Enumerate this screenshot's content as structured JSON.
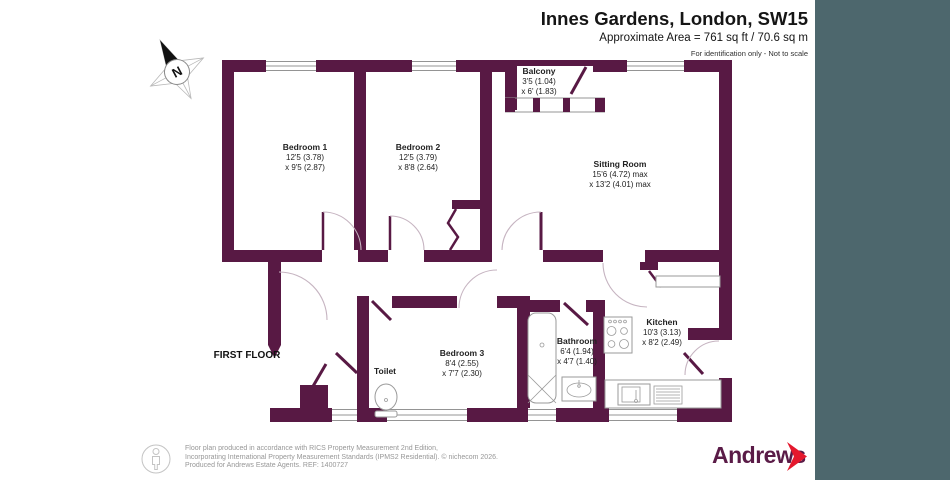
{
  "header": {
    "title": "Innes Gardens, London, SW15",
    "area": "Approximate Area = 761 sq ft / 70.6 sq m",
    "note": "For identification only - Not to scale"
  },
  "compass": {
    "label": "N"
  },
  "plan": {
    "floor_label": "FIRST FLOOR",
    "rooms": {
      "bedroom1": {
        "name": "Bedroom 1",
        "dim1": "12'5 (3.78)",
        "dim2": "x 9'5 (2.87)"
      },
      "bedroom2": {
        "name": "Bedroom 2",
        "dim1": "12'5 (3.79)",
        "dim2": "x 8'8 (2.64)"
      },
      "balcony": {
        "name": "Balcony",
        "dim1": "3'5 (1.04)",
        "dim2": "x 6' (1.83)"
      },
      "sitting_room": {
        "name": "Sitting Room",
        "dim1": "15'6 (4.72) max",
        "dim2": "x 13'2 (4.01) max"
      },
      "bedroom3": {
        "name": "Bedroom 3",
        "dim1": "8'4 (2.55)",
        "dim2": "x 7'7 (2.30)"
      },
      "toilet": {
        "name": "Toilet"
      },
      "bathroom": {
        "name": "Bathroom",
        "dim1": "6'4 (1.94)",
        "dim2": "x 4'7 (1.40)"
      },
      "kitchen": {
        "name": "Kitchen",
        "dim1": "10'3 (3.13)",
        "dim2": "x 8'2 (2.49)"
      }
    }
  },
  "footer": {
    "line1": "Floor plan produced in accordance with RICS Property Measurement 2nd Edition,",
    "line2": "Incorporating International Property Measurement Standards (IPMS2 Residential).  © nichecom 2026.",
    "line3": "Produced for Andrews Estate Agents.   REF: 1400727",
    "brand": "Andrews"
  },
  "colors": {
    "wall": "#581944",
    "panel": "#4d676d",
    "brand_red": "#e4182d"
  }
}
